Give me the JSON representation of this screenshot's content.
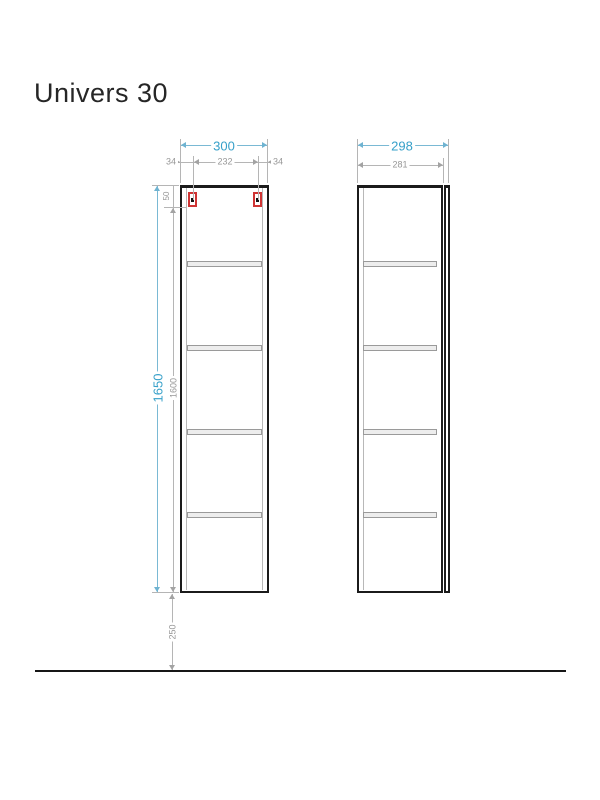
{
  "title": "Univers 30",
  "colors": {
    "accent": "#36a0c9",
    "dim_gray": "#979797",
    "outline": "#1b1b1b",
    "bracket_red": "#cf3434",
    "shelf_fill": "#ededed"
  },
  "front_view": {
    "dims": {
      "width_total": "300",
      "width_left": "34",
      "width_inner": "232",
      "width_right": "34",
      "height_total": "1650",
      "height_inner": "1600",
      "bracket_offset": "50",
      "floor_gap": "250"
    },
    "shelf_count": 4,
    "bracket_count": 2
  },
  "side_view": {
    "dims": {
      "depth_total": "298",
      "depth_body": "281"
    },
    "shelf_count": 4
  }
}
